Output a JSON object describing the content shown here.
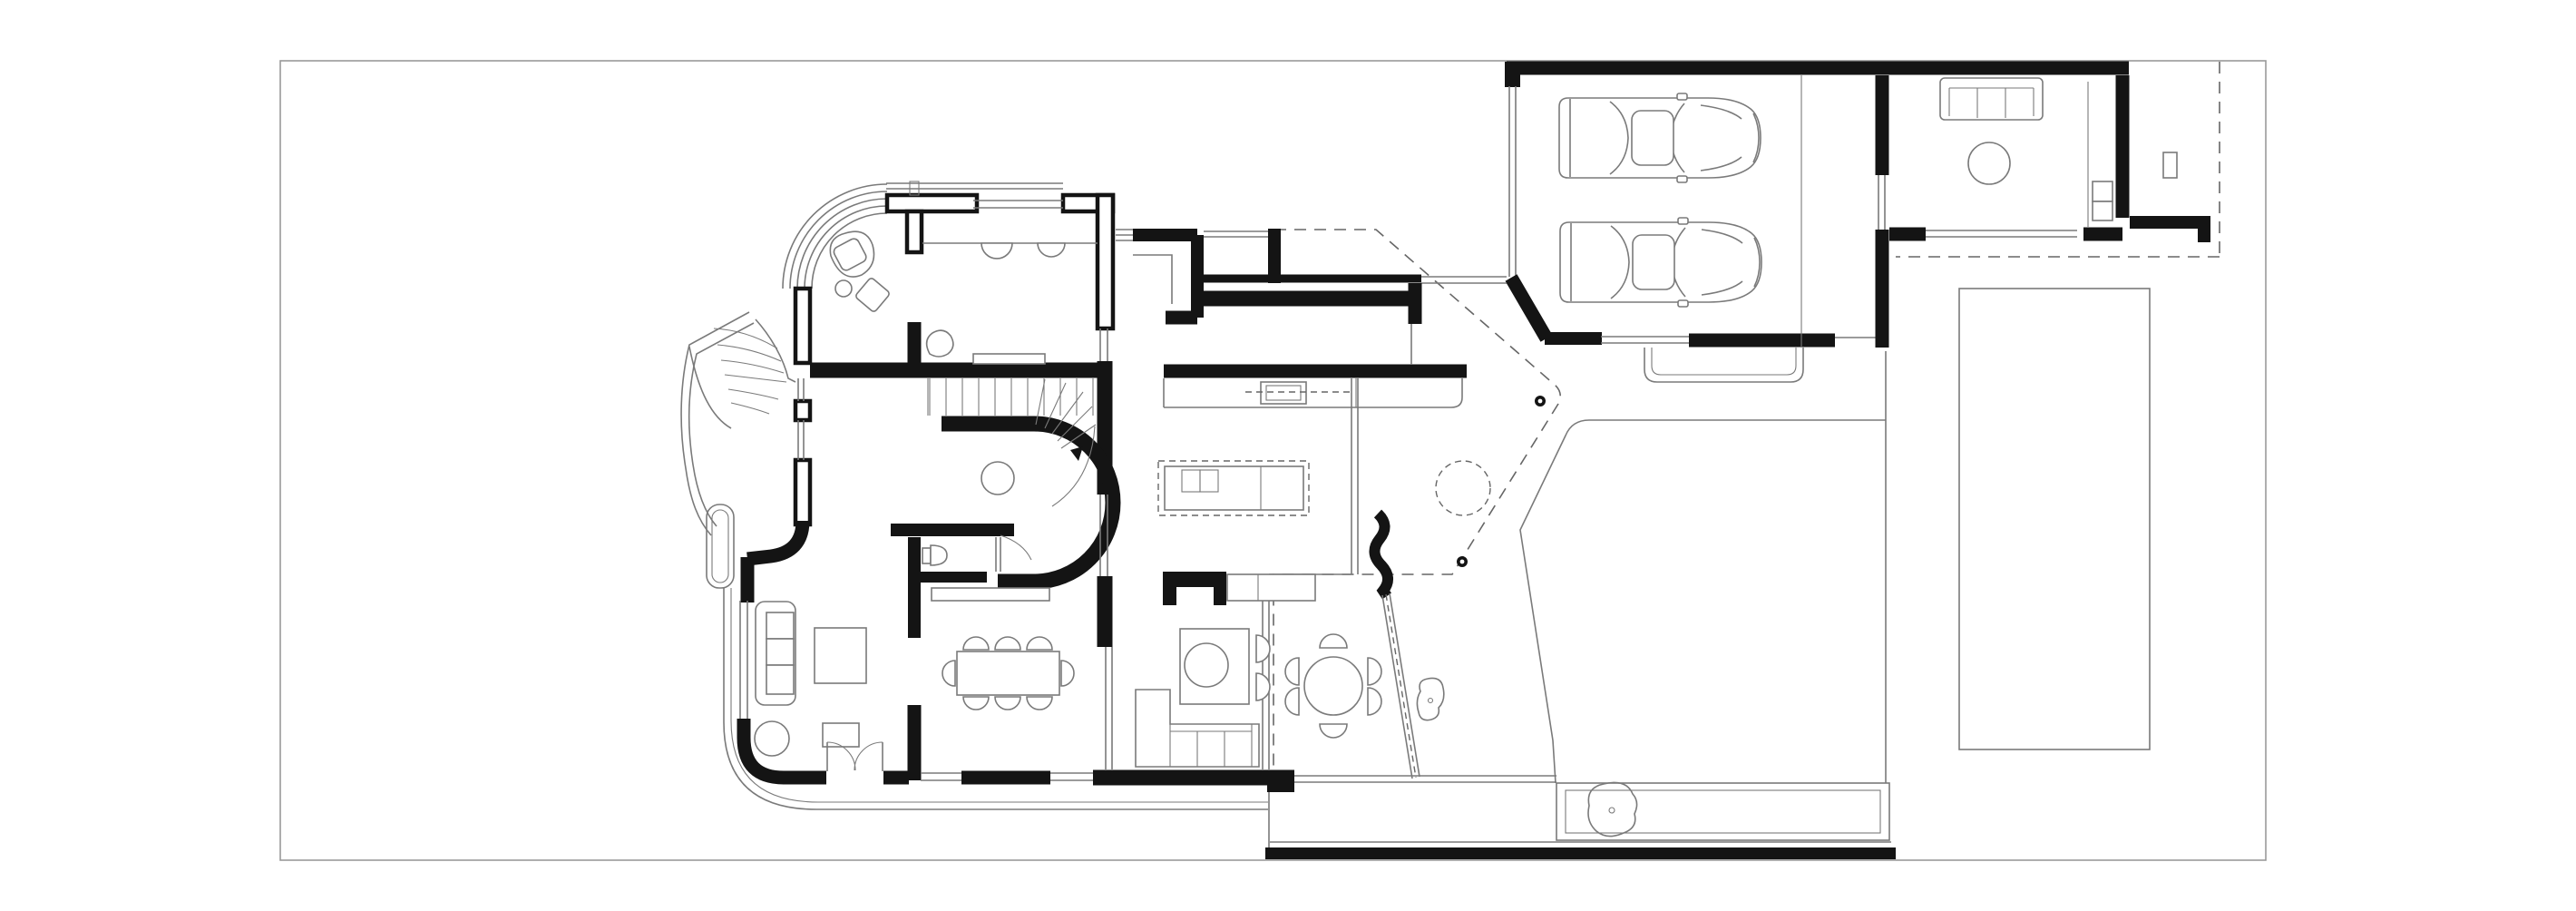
{
  "drawing": {
    "label": "Ground floor architectural plan with garage, guest house, pool and garden",
    "background": "#ffffff",
    "ink": "#141414",
    "line": "#7a7a7a",
    "dash": "#666666",
    "paper": "#999999"
  },
  "rooms": [
    {
      "id": "entry",
      "name": "entry vestibule"
    },
    {
      "id": "study",
      "name": "study with window desk"
    },
    {
      "id": "hall",
      "name": "stair hall"
    },
    {
      "id": "wc",
      "name": "wc"
    },
    {
      "id": "living",
      "name": "living room"
    },
    {
      "id": "dining",
      "name": "dining room"
    },
    {
      "id": "kitchen",
      "name": "kitchen"
    },
    {
      "id": "family",
      "name": "family room"
    },
    {
      "id": "garage",
      "name": "two car garage"
    },
    {
      "id": "guest",
      "name": "guest house"
    },
    {
      "id": "terrace",
      "name": "terrace"
    },
    {
      "id": "lawn",
      "name": "lawn"
    },
    {
      "id": "pool",
      "name": "swimming pool"
    },
    {
      "id": "driveway",
      "name": "driveway retaining wall"
    }
  ],
  "site": {
    "counts": {
      "cars": 2,
      "dining_chairs": 8,
      "outdoor_dining_chairs": 6,
      "sofa_seats": 3,
      "stair_straight_treads": 11,
      "trees": 1,
      "columns": 2,
      "boulders": 2
    }
  }
}
